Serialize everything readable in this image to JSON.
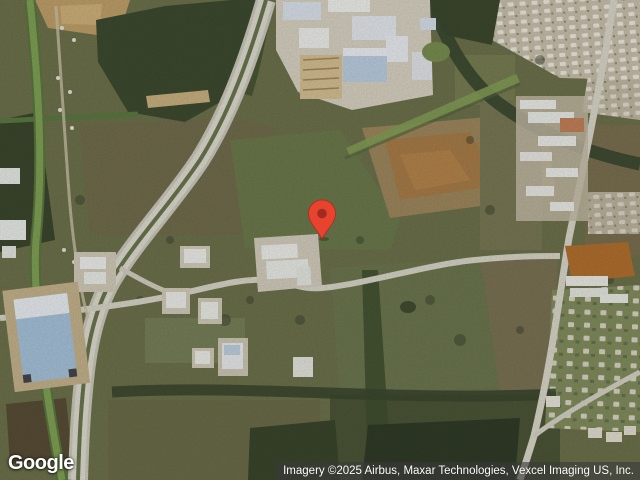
{
  "map": {
    "provider": "Google",
    "view_type": "satellite",
    "marker": {
      "color": "#E8432F",
      "outline_color": "#B4281E",
      "dot_color": "#A12B21",
      "x": 322,
      "y": 238
    }
  },
  "logo": {
    "text": "Google"
  },
  "attribution": {
    "text": "Imagery ©2025 Airbus, Maxar Technologies, Vexcel Imaging US, Inc.",
    "text_color": "#ffffff"
  }
}
